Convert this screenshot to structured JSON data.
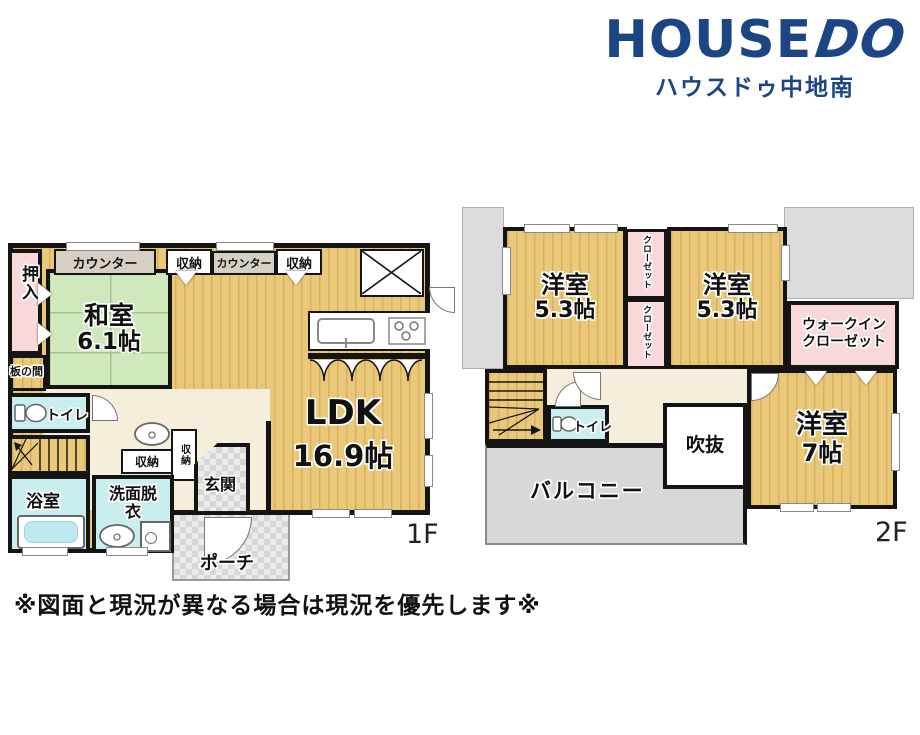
{
  "logo": {
    "brand_head": "HOUSE",
    "brand_tail": "DO",
    "subtitle": "ハウスドゥ中地南"
  },
  "disclaimer": "※図面と現況が異なる場合は現況を優先します※",
  "floor1": {
    "label": "1F",
    "rooms": {
      "oshiire": "押入",
      "counter": "カウンター",
      "shuno": "収納",
      "washitsu": "和室",
      "washitsu_size": "6.1帖",
      "itanoma": "板の間",
      "toilet": "トイレ",
      "ldk": "LDK",
      "ldk_size": "16.9帖",
      "bath": "浴室",
      "senmen": "洗面脱衣",
      "genkan": "玄関",
      "porch": "ポーチ"
    }
  },
  "floor2": {
    "label": "2F",
    "rooms": {
      "yoshitsu": "洋室",
      "yoshitsu53_size": "5.3帖",
      "closet": "クローゼット",
      "wic": "ウォークインクローゼット",
      "yoshitsu7_size": "7帖",
      "fukinuke": "吹抜",
      "toilet": "トイレ",
      "balcony": "バルコニー"
    }
  },
  "colors": {
    "brand_navy": "#1c4586",
    "wood_floor": "#eac87a",
    "tatami_green": "#cfe9bc",
    "closet_pink": "#f8d8d8",
    "wet_cyan": "#c8eef0",
    "hall_cream": "#f5eedb",
    "outside_gray": "#dcdcdc",
    "wall_black": "#141414"
  }
}
